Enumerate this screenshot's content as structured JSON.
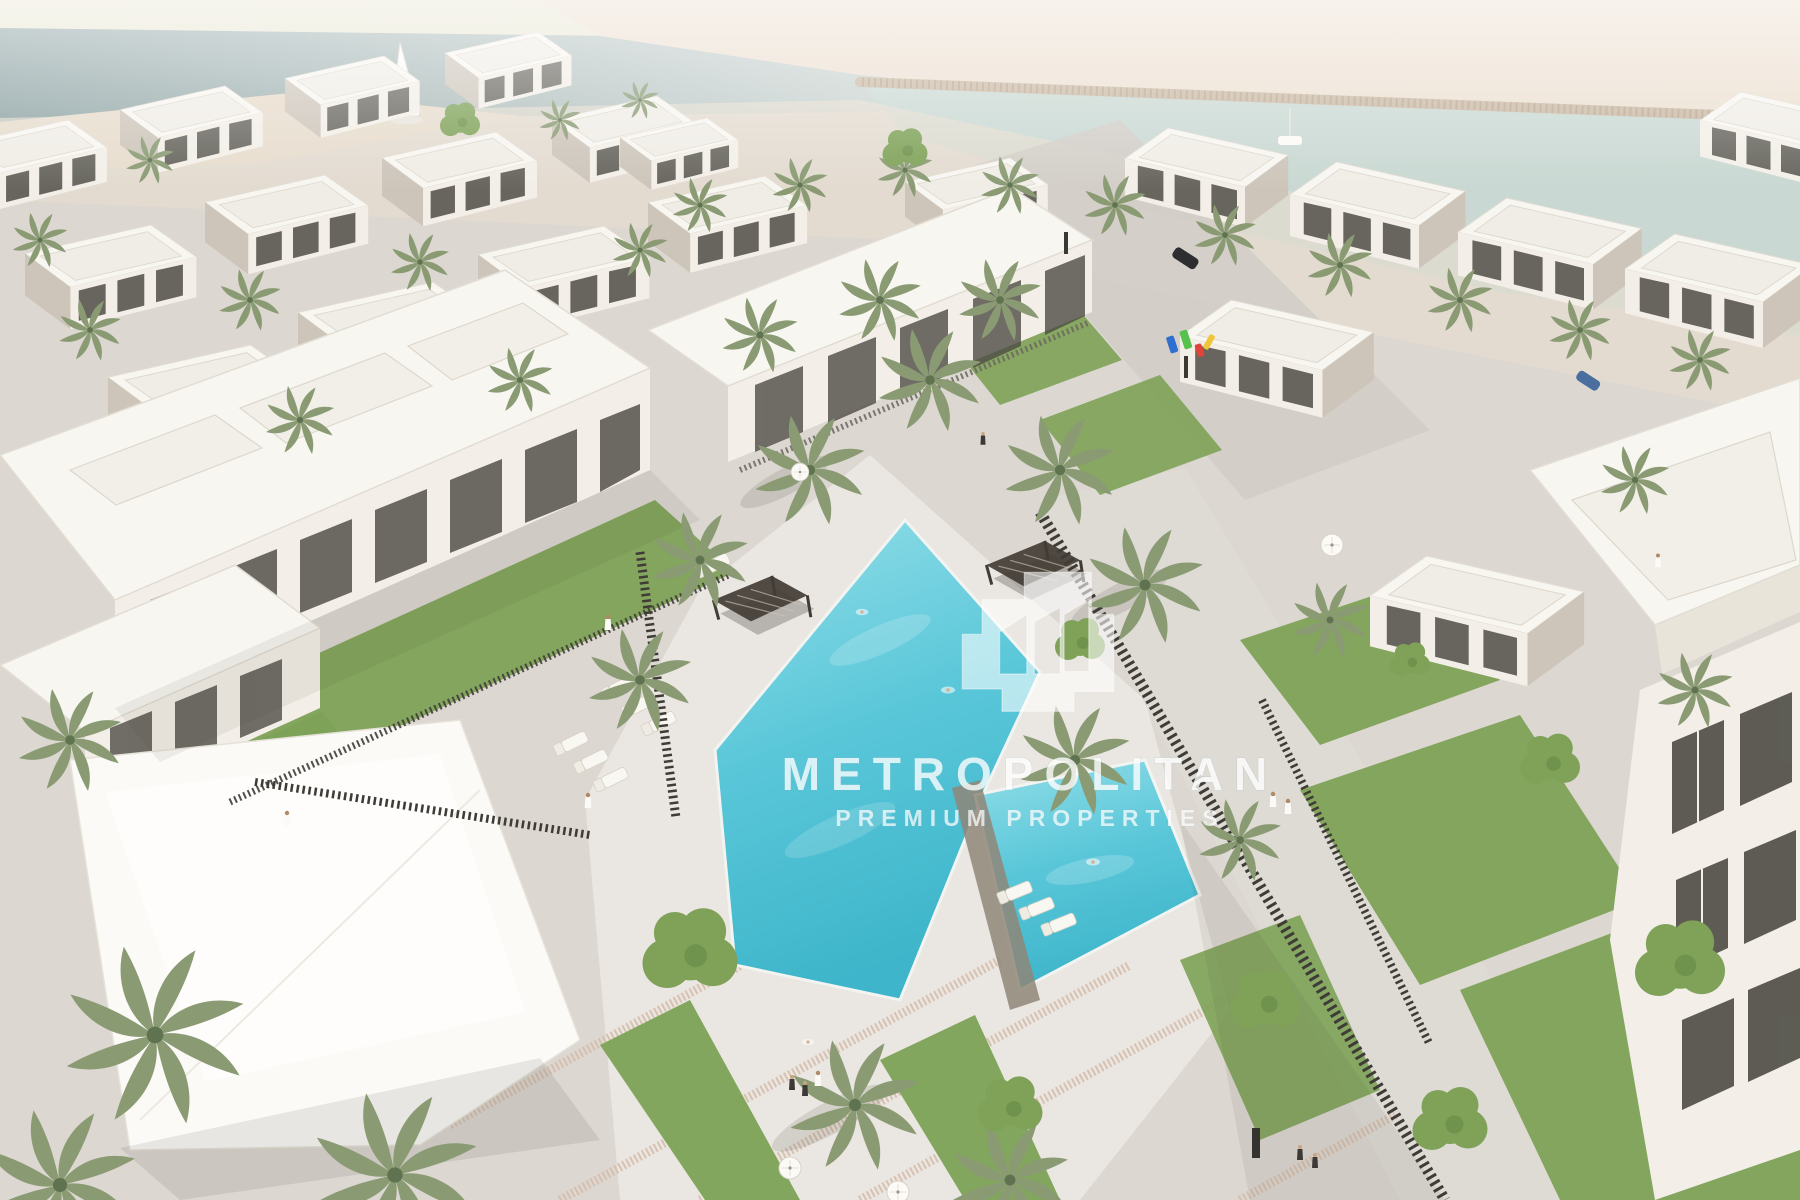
{
  "watermark": {
    "brand": "METROPOLITAN",
    "tagline": "PREMIUM PROPERTIES",
    "logo_icon": "metropolitan-buildings-logo"
  },
  "colors": {
    "sky": "#e9e6d4",
    "sea": "#8da2a3",
    "sea_light": "#cdd6d3",
    "sand": "#ecdfd0",
    "sand_spit": "#e7dac9",
    "channel": "#c9d8d2",
    "seawall": "#c9b8a2",
    "paving": "#dcd7d1",
    "deck": "#eae6e1",
    "promenade": "#dedad4",
    "street": "#d2cdc6",
    "pebble": "#d5bba9",
    "lawn": "#7da256",
    "palm": "#8a9b74",
    "palm_core": "#5f7350",
    "tree": "#7fa258",
    "building_white": "#f8f6f1",
    "building_face": "#f3efe8",
    "building_shade": "#cdc5ba",
    "window_dark": "#4e4c45",
    "fence": "#3f3c37",
    "pergola": "#423d34",
    "canopy": "#fbfaf7",
    "pool_light": "#93dee8",
    "pool_mid": "#5ac7d9",
    "pool_deep": "#3eb5ca",
    "car_dark": "#2e2e30",
    "car_blue": "#4a6e9e",
    "play_blue": "#2f6fd0",
    "play_green": "#58c14d",
    "play_red": "#e04438",
    "play_yellow": "#f0c53a",
    "watermark": "#ffffff"
  }
}
